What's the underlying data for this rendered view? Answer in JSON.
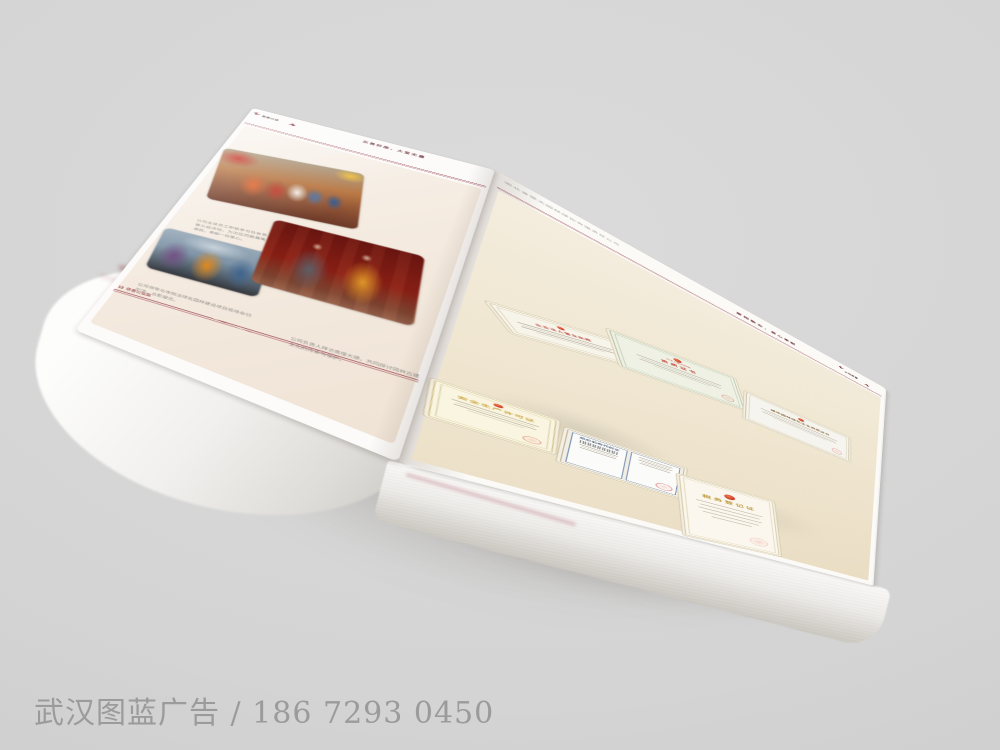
{
  "watermark": {
    "text": "武汉图蓝广告 / 186 7293 0450"
  },
  "book": {
    "left_page": {
      "chapter_badge": "慈善公益",
      "header_slogan": "乐善好施，大爱无疆",
      "photos": [
        {
          "name": "charity-festival-crowd",
          "caption": "公司全体员工积极参与社会慈善公益活动，为灾区同胞募集善款，奉献一份爱心。"
        },
        {
          "name": "leaders-with-monk-outdoor",
          "caption": "公司领导与寺院法师在园林建设项目现场亲切交流，合影留念。"
        },
        {
          "name": "temple-visit-meeting",
          "caption": "公司负责人拜访高僧大德，共同探讨园林古建文化的传承与保护。"
        }
      ],
      "footer": {
        "page_number": "12",
        "label": "慈善公益篇"
      }
    },
    "right_page": {
      "company_name": "湖北省楚天园林绿化有限责任公司",
      "header_slogan": "爱岗敬业，爱心奉献",
      "chapter_badge": "公司荣誉",
      "certificates": [
        {
          "id": "business-license",
          "title": "企业法人营业执照"
        },
        {
          "id": "qualification-certificate",
          "subtitle": "中华人民共和国",
          "title": "资质证书"
        },
        {
          "id": "landscaping-qualification",
          "title": "城市园林绿化企业资质证书"
        },
        {
          "id": "safety-production-license",
          "title": "安全生产许可证"
        },
        {
          "id": "organization-code-certificate",
          "title": "组织机构代码证"
        },
        {
          "id": "tax-registration-certificate",
          "title": "税务登记证"
        }
      ]
    }
  },
  "colors": {
    "background": "#d4d4d4",
    "accent_red": "#8a2a35",
    "page_cream": "#efe5cf",
    "watermark_gray": "#9b9b9b"
  }
}
